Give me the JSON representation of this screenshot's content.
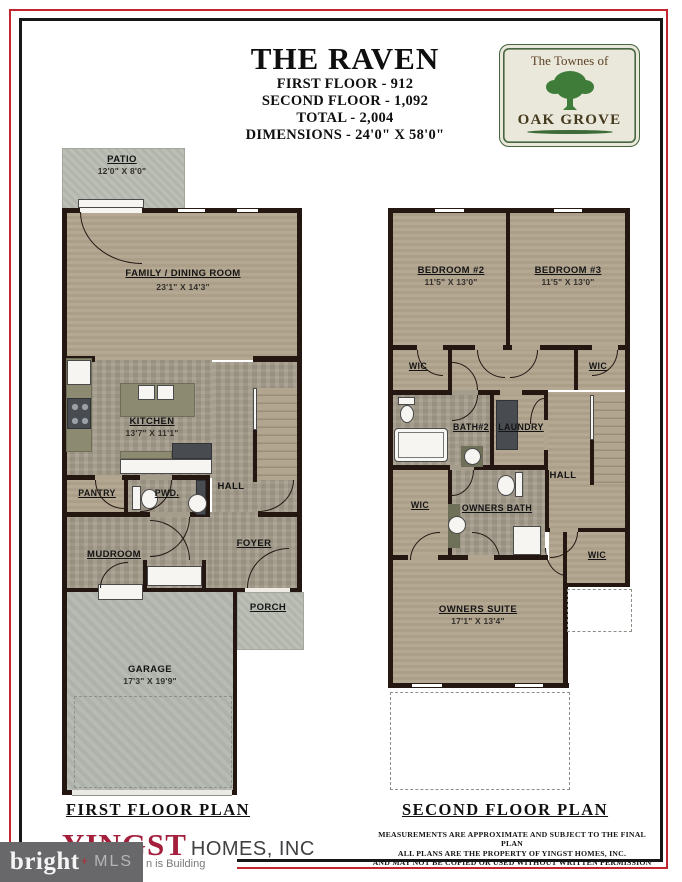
{
  "header": {
    "title": "THE RAVEN",
    "line1": "FIRST FLOOR - 912",
    "line2": "SECOND FLOOR - 1,092",
    "line3": "TOTAL - 2,004",
    "line4": "DIMENSIONS - 24'0\" X 58'0\""
  },
  "badge": {
    "community_prefix": "The Townes of",
    "community_name": "OAK GROVE"
  },
  "floor1": {
    "title": "FIRST FLOOR PLAN",
    "patio": {
      "name": "PATIO",
      "dims": "12'0\" X 8'0\""
    },
    "family": {
      "name": "FAMILY / DINING ROOM",
      "dims": "23'1\" X 14'3\""
    },
    "kitchen": {
      "name": "KITCHEN",
      "dims": "13'7\" X 11'1\""
    },
    "pantry": {
      "name": "PANTRY"
    },
    "powder": {
      "name": "PWD."
    },
    "hall": {
      "name": "HALL"
    },
    "mudroom": {
      "name": "MUDROOM"
    },
    "foyer": {
      "name": "FOYER"
    },
    "porch": {
      "name": "PORCH"
    },
    "garage": {
      "name": "GARAGE",
      "dims": "17'3\" X 19'9\""
    }
  },
  "floor2": {
    "title": "SECOND FLOOR PLAN",
    "bedroom2": {
      "name": "BEDROOM #2",
      "dims": "11'5\" X 13'0\""
    },
    "bedroom3": {
      "name": "BEDROOM #3",
      "dims": "11'5\" X 13'0\""
    },
    "wic_bedroom2": {
      "name": "WIC"
    },
    "wic_bedroom3": {
      "name": "WIC"
    },
    "bath2": {
      "name": "BATH#2"
    },
    "laundry": {
      "name": "LAUNDRY"
    },
    "hall": {
      "name": "HALL"
    },
    "wic_owners_left": {
      "name": "WIC"
    },
    "owners_bath": {
      "name": "OWNERS BATH"
    },
    "wic_owners_right": {
      "name": "WIC"
    },
    "owners_suite": {
      "name": "OWNERS SUITE",
      "dims": "17'1\" X 13'4\""
    }
  },
  "footer": {
    "builder_accent": "YINGST",
    "builder_rest": "HOMES, INC",
    "tagline_visible": "n is Building",
    "disclaimer_line1": "MEASUREMENTS ARE APPROXIMATE AND SUBJECT TO THE FINAL PLAN",
    "disclaimer_line2": "ALL PLANS ARE THE PROPERTY OF YINGST HOMES, INC.",
    "disclaimer_line3": "AND MAY NOT BE COPIED OR USED WITHOUT WRITTEN PERMISSION"
  },
  "watermark": {
    "brand": "bright",
    "suffix": "MLS"
  },
  "colors": {
    "frame_red": "#c32530",
    "frame_black": "#171717",
    "wall": "#241712",
    "floor_tan": "#b2a58f",
    "floor_stone": "#a59d8c",
    "concrete": "#b9bcb3",
    "garage_gray": "#b4b8b0",
    "counter_olive": "#8c8b71",
    "builder_crimson": "#a31f3c",
    "badge_green": "#47663f",
    "tree_green": "#3f7c3a",
    "watermark_gray": "#68686b"
  }
}
